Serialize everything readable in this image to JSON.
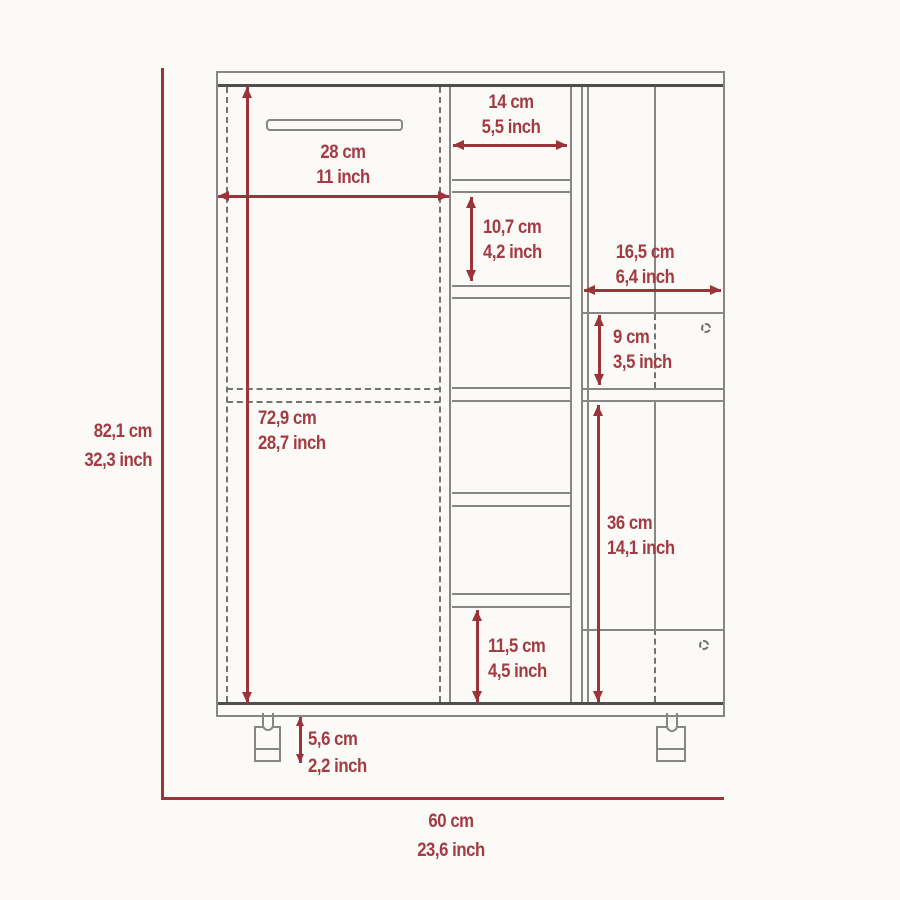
{
  "colors": {
    "dimension_red": "#9c323a",
    "dimension_text_red": "#a23b43",
    "cabinet_line_gray": "#868686"
  },
  "dims": {
    "overall_height": {
      "cm": "82,1 cm",
      "inch": "32,3 inch"
    },
    "overall_width": {
      "cm": "60 cm",
      "inch": "23,6 inch"
    },
    "interior_height": {
      "cm": "72,9 cm",
      "inch": "28,7 inch"
    },
    "left_door_width": {
      "cm": "28 cm",
      "inch": "11 inch"
    },
    "center_shelf_width": {
      "cm": "14 cm",
      "inch": "5,5 inch"
    },
    "center_shelf_height": {
      "cm": "10,7 cm",
      "inch": "4,2 inch"
    },
    "right_section_width": {
      "cm": "16,5 cm",
      "inch": "6,4 inch"
    },
    "upper_right_door_height": {
      "cm": "9 cm",
      "inch": "3,5 inch"
    },
    "lower_right_section_height": {
      "cm": "36 cm",
      "inch": "14,1 inch"
    },
    "bottom_center_shelf_height": {
      "cm": "11,5 cm",
      "inch": "4,5 inch"
    },
    "leg_height": {
      "cm": "5,6 cm",
      "inch": "2,2 inch"
    }
  }
}
